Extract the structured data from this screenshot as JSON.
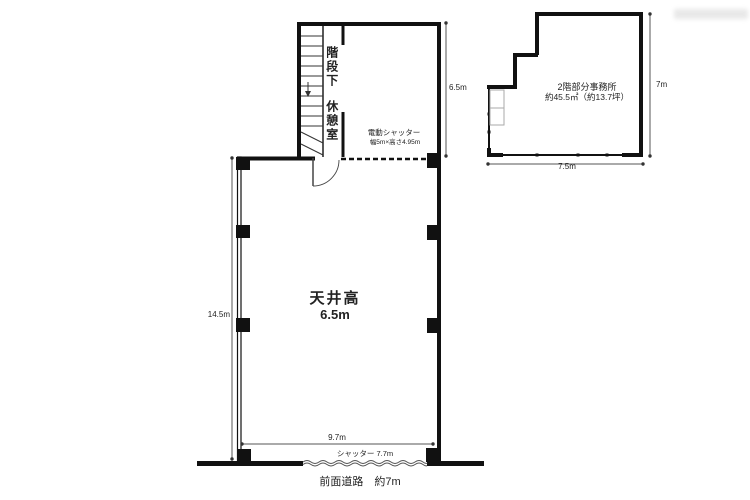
{
  "plan1f": {
    "ceiling_label": "天井高",
    "ceiling_value": "6.5m",
    "stair_label_upper": "階段下",
    "stair_label_lower": "休憩室",
    "electric_shutter_line1": "電動シャッター",
    "electric_shutter_line2": "幅5m×高さ4.95m",
    "shutter_label": "シャッター 7.7m",
    "front_road_label": "前面道路　約7m",
    "dim_left": "14.5m",
    "dim_upper_right": "6.5m",
    "dim_bottom": "9.7m"
  },
  "plan2f": {
    "label_line1": "2階部分事務所",
    "label_line2": "約45.5㎡（約13.7坪）",
    "dim_right": "7m",
    "dim_bottom": "7.5m"
  },
  "colors": {
    "wall": "#111111",
    "dimension_line": "#555555",
    "text": "#222222",
    "background": "#ffffff"
  }
}
